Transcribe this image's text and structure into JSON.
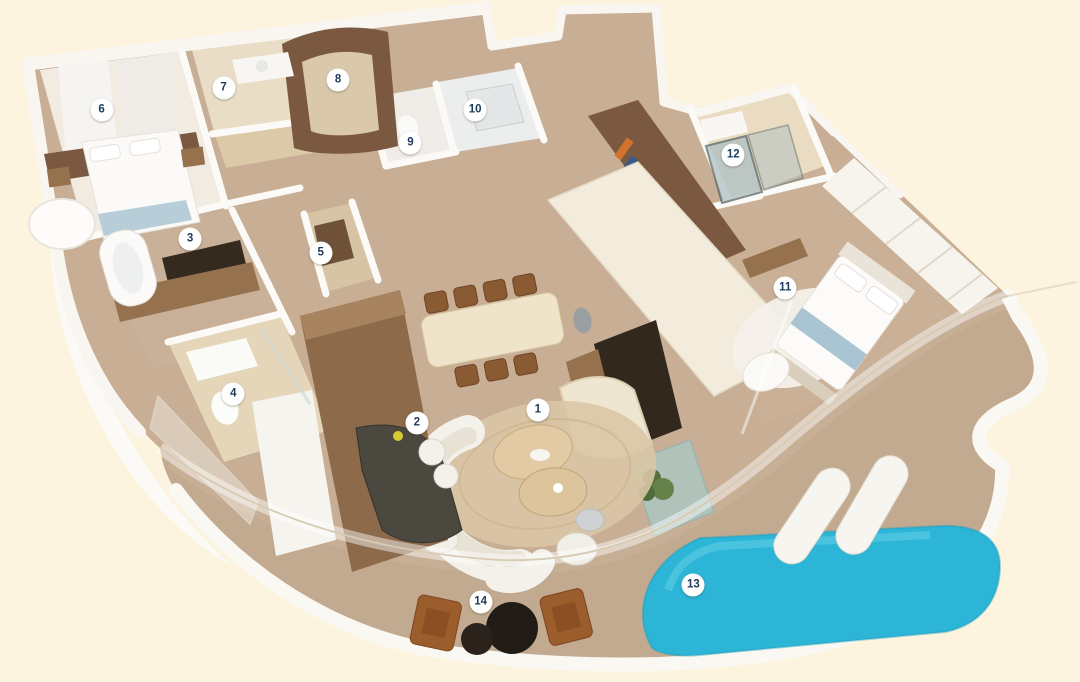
{
  "page": {
    "description": "3D isometric floor plan rendering of a luxury suite with curved balcony, plunge pool and numbered room markers"
  },
  "floorplan": {
    "colors": {
      "background": "#fcf4de",
      "deck": "#c2aa90",
      "carpet": "#c7ae94",
      "pool": "#2cb5d7",
      "wall-white": "#f9f6f1",
      "wood-dark": "#7b5940",
      "wood-mid": "#96714e",
      "oak-light": "#e8dabc",
      "glass": "#dff0f2",
      "marker-bg": "#ffffff",
      "marker-text": "#1d3a5c"
    },
    "markers": [
      {
        "number": "1",
        "x": 49.8,
        "y": 60.1
      },
      {
        "number": "2",
        "x": 38.6,
        "y": 62.0
      },
      {
        "number": "3",
        "x": 17.6,
        "y": 35.0
      },
      {
        "number": "4",
        "x": 21.6,
        "y": 57.8
      },
      {
        "number": "5",
        "x": 29.7,
        "y": 37.1
      },
      {
        "number": "6",
        "x": 9.4,
        "y": 16.1
      },
      {
        "number": "7",
        "x": 20.7,
        "y": 12.9
      },
      {
        "number": "8",
        "x": 31.3,
        "y": 11.7
      },
      {
        "number": "9",
        "x": 38.0,
        "y": 21.0
      },
      {
        "number": "10",
        "x": 44.0,
        "y": 16.1
      },
      {
        "number": "11",
        "x": 72.7,
        "y": 42.2
      },
      {
        "number": "12",
        "x": 67.9,
        "y": 22.7
      },
      {
        "number": "13",
        "x": 64.2,
        "y": 85.8
      },
      {
        "number": "14",
        "x": 44.5,
        "y": 88.3
      }
    ]
  }
}
